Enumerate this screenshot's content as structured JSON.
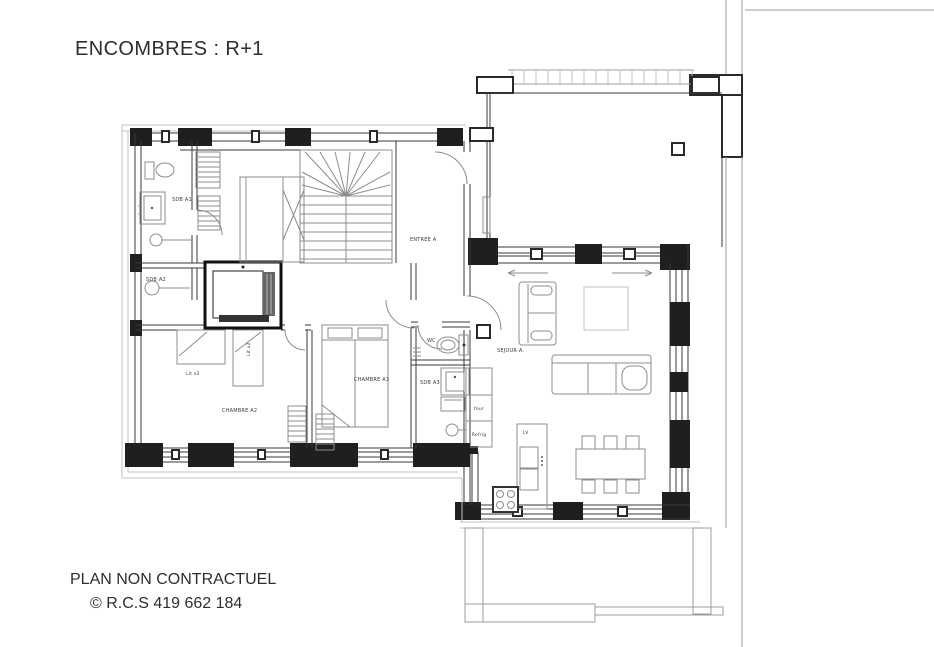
{
  "title": "ENCOMBRES : R+1",
  "footer": {
    "line1": "PLAN NON CONTRACTUEL",
    "line2": "© R.C.S 419 662 184"
  },
  "colors": {
    "background": "#ffffff",
    "ink": "#2e2e2e",
    "wall": "#1f1f1f",
    "furniture_line": "#8c8c8c",
    "context_line": "#9c9c9c",
    "trim_line": "#c2c2c2"
  },
  "plan": {
    "rooms": {
      "sdb_a1": "SDB A1",
      "sdb_a2": "SDB A2",
      "entree_a": "ENTREE A",
      "wc": "WC",
      "sdb_a3": "SDB A3",
      "chambre_a2": "CHAMBRE A2",
      "chambre_a3": "CHAMBRE A3",
      "sejour_a": "SEJOUR A."
    },
    "furniture_labels": {
      "lit_a2_horizontal": "Lit x2",
      "lit_a2_vertical": "Lit x2",
      "oven": "four",
      "fridge": "Refrig",
      "dishwasher": "LV"
    }
  }
}
